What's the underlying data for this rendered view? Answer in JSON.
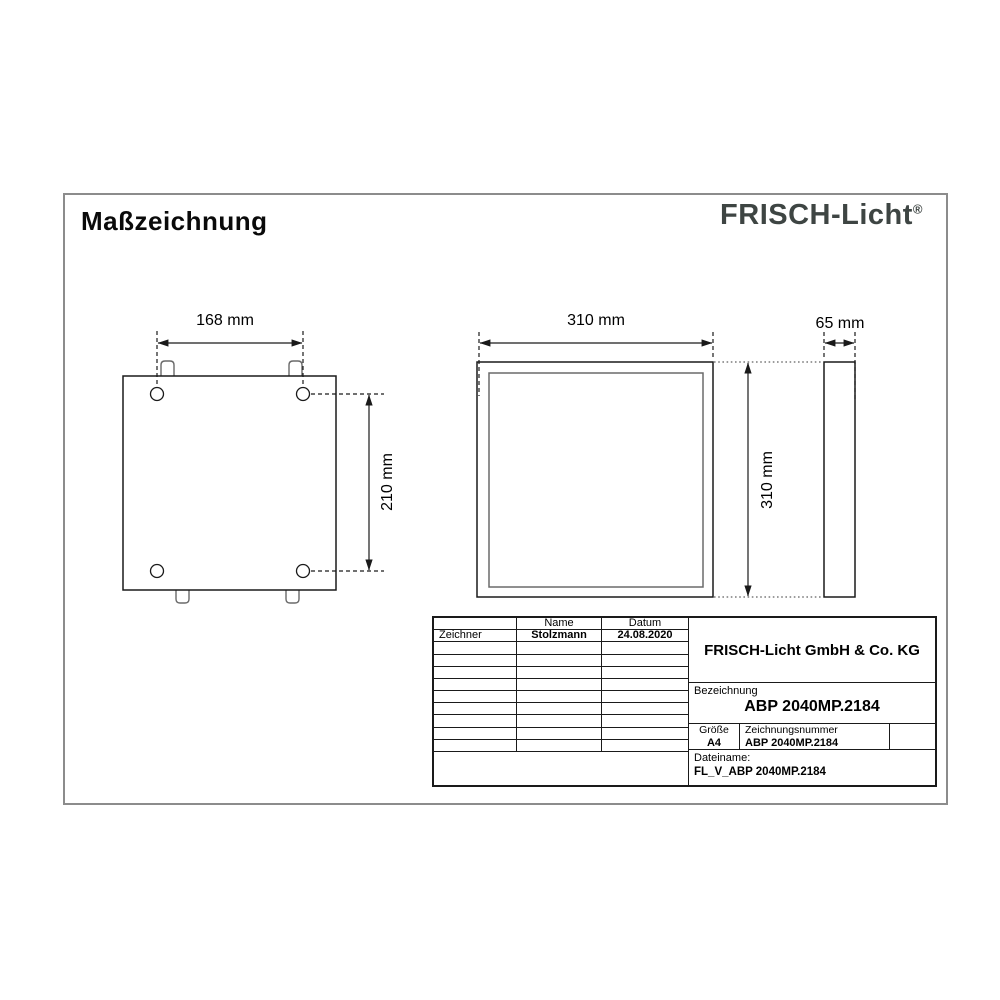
{
  "page": {
    "title": "Maßzeichnung"
  },
  "brand": {
    "logo_text": "FRISCH-Licht",
    "registered_mark": "®",
    "logo_color": "#3e4543"
  },
  "drawing": {
    "back_view": {
      "width_dim": "168 mm",
      "height_dim": "210 mm"
    },
    "front_view": {
      "width_dim": "310 mm",
      "height_dim": "310 mm"
    },
    "side_view": {
      "depth_dim": "65 mm"
    }
  },
  "title_block": {
    "headers": {
      "name": "Name",
      "date": "Datum"
    },
    "rows": [
      {
        "role": "Zeichner",
        "name": "Stolzmann",
        "date": "24.08.2020"
      }
    ],
    "company": "FRISCH-Licht GmbH & Co. KG",
    "designation_label": "Bezeichnung",
    "designation_value": "ABP 2040MP.2184",
    "size_label": "Größe",
    "size_value": "A4",
    "drawing_number_label": "Zeichnungsnummer",
    "drawing_number_value": "ABP 2040MP.2184",
    "filename_label": "Dateiname:",
    "filename_value": "FL_V_ABP 2040MP.2184"
  }
}
